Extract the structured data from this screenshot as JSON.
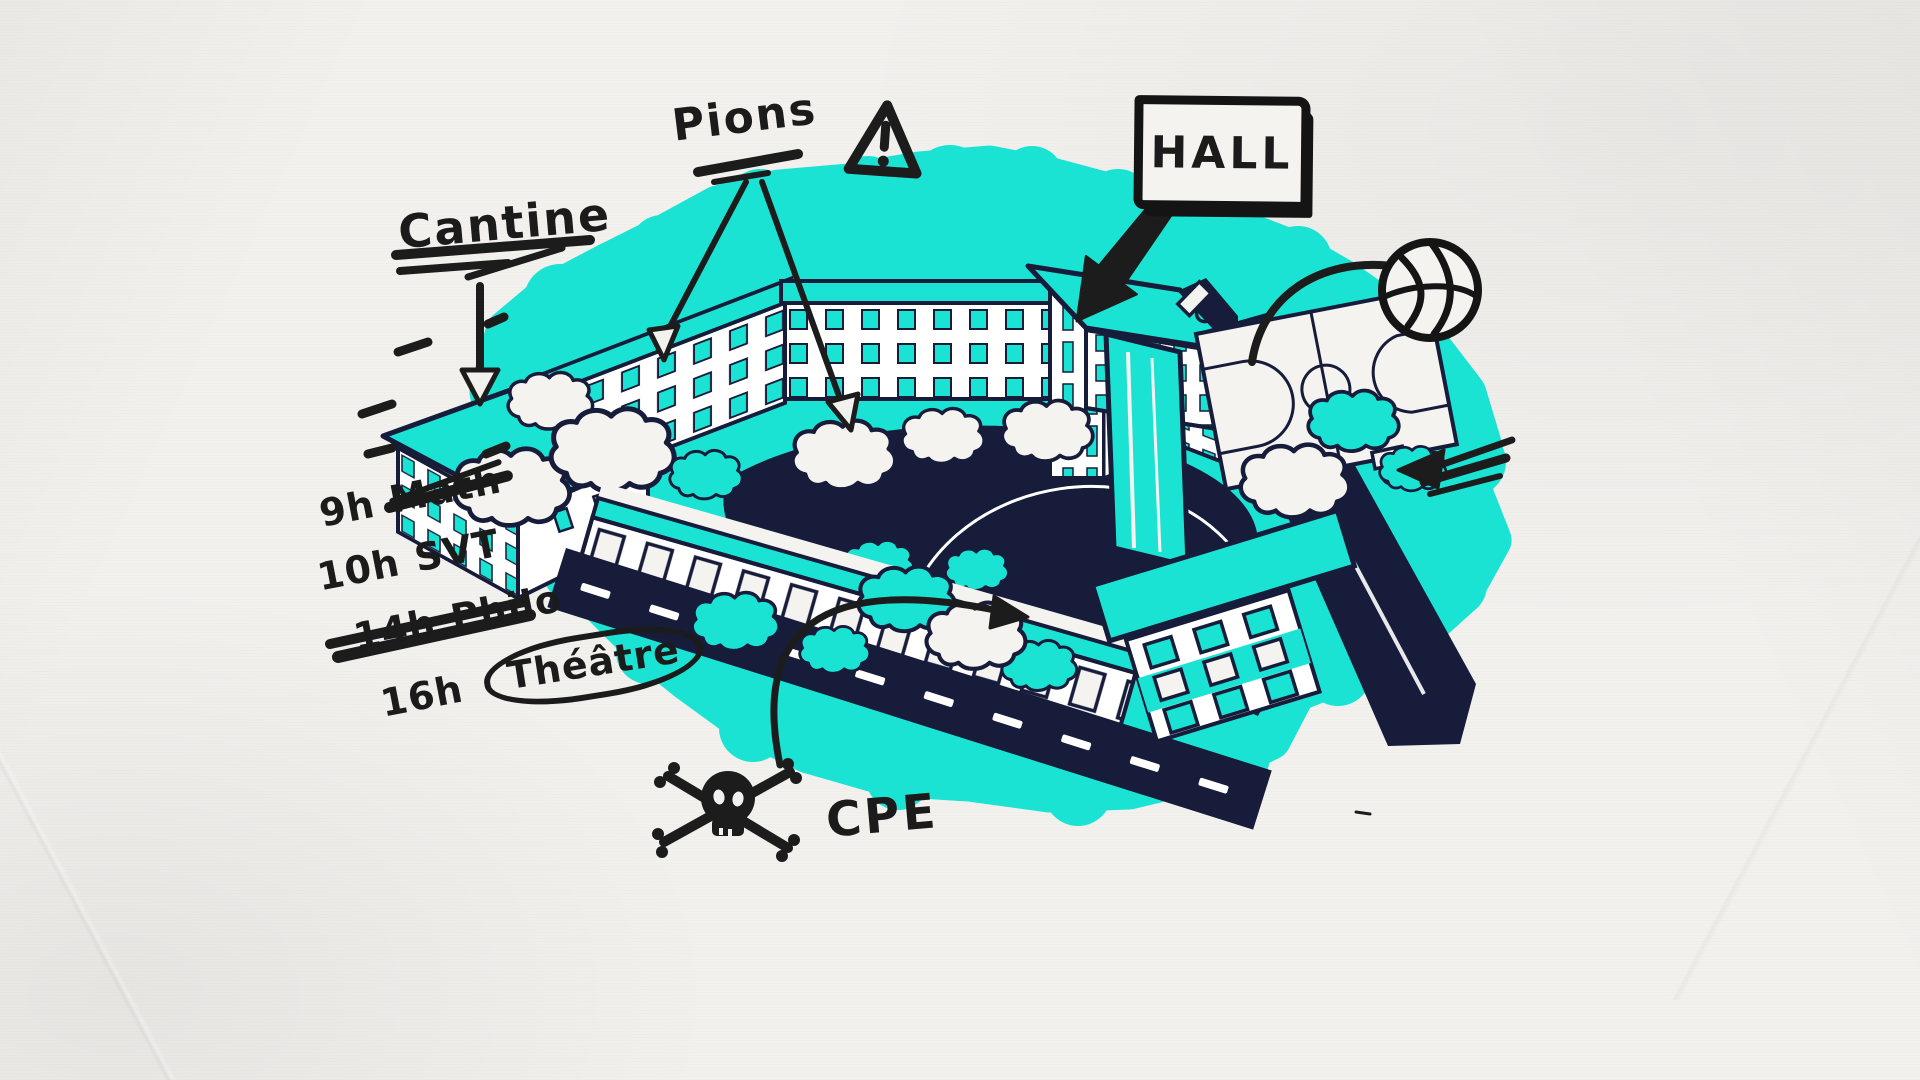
{
  "illustration": {
    "description": "Hand-drawn isometric map of a school campus on paper background",
    "colors": {
      "teal": "#1BE3D4",
      "navy": "#161C3A",
      "ink": "#1C1C1C",
      "paper": "#F2F1EE"
    }
  },
  "labels": {
    "cantine": "Cantine",
    "pions": "Pions",
    "hall": "HALL",
    "cpe": "CPE"
  },
  "schedule": {
    "items": [
      {
        "time": "9h",
        "subject": "Math",
        "struck": true,
        "circled": false
      },
      {
        "time": "10h",
        "subject": "SVT",
        "struck": false,
        "circled": false
      },
      {
        "time": "14h",
        "subject": "Philo",
        "struck": false,
        "circled": false
      },
      {
        "time": "16h",
        "subject": "Théâtre",
        "struck": false,
        "circled": true
      }
    ]
  },
  "icons": {
    "warning_triangle": "⚠",
    "skull_crossbones": "☠",
    "basketball": "🏀"
  }
}
